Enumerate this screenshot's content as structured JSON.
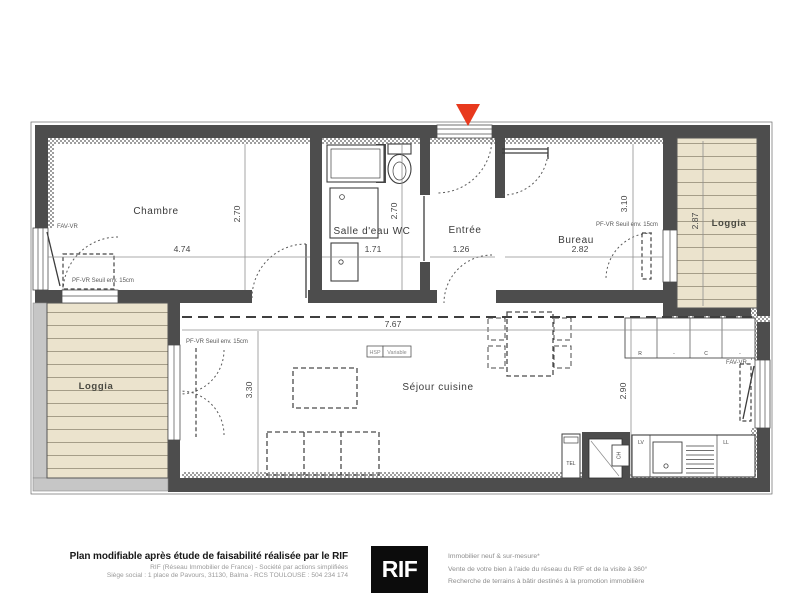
{
  "plan": {
    "rooms": {
      "chambre": "Chambre",
      "salle_deau": "Salle d'eau WC",
      "entree": "Entrée",
      "bureau": "Bureau",
      "loggia_right": "Loggia",
      "loggia_left": "Loggia",
      "sejour": "Séjour cuisine"
    },
    "dims": {
      "chambre_w": "4.74",
      "chambre_h": "2.70",
      "salle_deau_w": "1.71",
      "salle_deau_h": "2.70",
      "entree_w": "1.26",
      "bureau_w": "2.82",
      "bureau_h": "3.10",
      "loggia_right_h": "2.87",
      "sejour_w": "7.67",
      "sejour_h_left": "3.30",
      "sejour_h_right": "2.90"
    },
    "ann": {
      "fav_vr_left": "FAV-VR",
      "fav_vr_right": "FAV-VR",
      "pf_vr_chambre": "PF-VR Seuil env. 15cm",
      "pf_vr_sejour": "PF-VR Seuil env. 15cm",
      "pf_vr_bureau": "PF-VR Seuil env. 15cm",
      "hsp": "HSP",
      "variable": "Variable",
      "k_r": "R",
      "k_dot1": "-",
      "k_c": "C",
      "k_dot2": "-",
      "lv": "LV",
      "ll": "LL",
      "ch": "CH",
      "tel": "TEL"
    },
    "colors": {
      "wall": "#4d4d4d",
      "loggia_deck": "#ebe3cd",
      "entry_marker": "#e8391d"
    }
  },
  "footer": {
    "left_bold": "Plan modifiable après étude de faisabilité réalisée par le RIF",
    "left_line2": "RIF (Réseau Immobilier de France) - Société par actions simplifiées",
    "left_line3": "Siège social : 1 place de Pavours, 31130, Balma - RCS TOULOUSE : 504 234 174",
    "logo_text": "RIF",
    "right_line1": "Immobilier neuf & sur-mesure*",
    "right_line2": "Vente de votre bien à l'aide du réseau du RIF et de la visite à 360°",
    "right_line3": "Recherche de terrains à bâtir destinés à la promotion immobilière"
  }
}
